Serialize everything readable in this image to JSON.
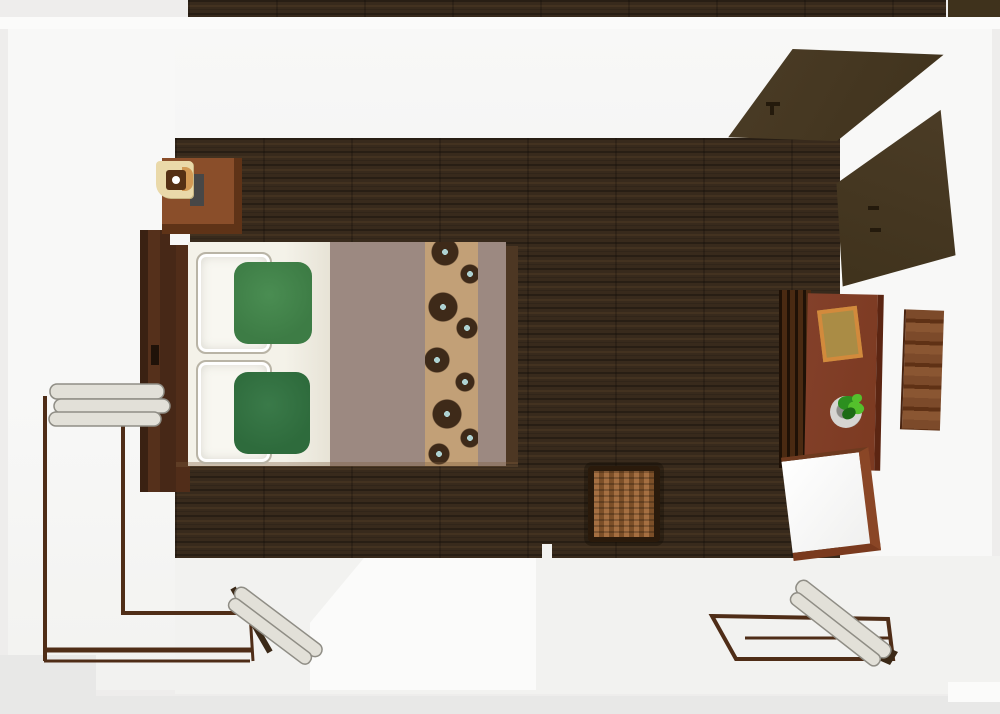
{
  "scene": {
    "title": "3D top-down render of a bedroom floor plan",
    "objects": [
      {
        "id": "room-floor",
        "label": "Dark walnut plank floor"
      },
      {
        "id": "hallway-floor",
        "label": "Adjacent floor strip beyond top wall"
      },
      {
        "id": "bed",
        "label": "Double bed with white sheets, taupe blanket and floral runner"
      },
      {
        "id": "headboard",
        "label": "Dark wood headboard"
      },
      {
        "id": "pillow-white-1",
        "label": "White pillow (top)"
      },
      {
        "id": "pillow-white-2",
        "label": "White pillow (bottom)"
      },
      {
        "id": "pillow-green-1",
        "label": "Green accent pillow (top)"
      },
      {
        "id": "pillow-green-2",
        "label": "Dark green accent pillow (bottom)"
      },
      {
        "id": "blanket",
        "label": "Taupe blanket"
      },
      {
        "id": "bed-runner-floral",
        "label": "Tan runner with brown flower pattern"
      },
      {
        "id": "nightstand",
        "label": "Wood nightstand"
      },
      {
        "id": "table-lamp",
        "label": "Square table lamp with cream shade"
      },
      {
        "id": "storage-basket",
        "label": "Wicker storage basket"
      },
      {
        "id": "desk",
        "label": "Sienna wood desk with drawers"
      },
      {
        "id": "desk-paper",
        "label": "Orange-bordered paper on desk"
      },
      {
        "id": "desk-plant",
        "label": "Potted green plant on desk"
      },
      {
        "id": "desk-chair",
        "label": "White chair with wood frame"
      },
      {
        "id": "wall-art",
        "label": "Wood-tone wall art"
      },
      {
        "id": "closet-door-upper",
        "label": "Open dark closet door panel (upper)"
      },
      {
        "id": "closet-door-lower",
        "label": "Open dark closet door panel (lower)"
      },
      {
        "id": "door-left",
        "label": "Open double door with white leaves, bottom-left"
      },
      {
        "id": "door-right",
        "label": "Open door with white leaf, bottom-right"
      }
    ]
  },
  "palette": {
    "outer": "#eeedec",
    "outerDark": "#e8e8e7",
    "wallWhite": "#f8f8f7",
    "wallBright": "#fbfbfa",
    "wallShade": "#f2f2f0",
    "floorBase": "#382a1c",
    "headboard": "#472817",
    "headboardDark": "#3a2112",
    "nightstandTop": "#8a4e2a",
    "nightstandEdge": "#5f3317",
    "lampShade": "#ead9a9",
    "lampRing": "#553014",
    "lampBulb": "#ffffff",
    "lampAccent": "#d29a55",
    "lampShadow": "#474747",
    "sheet": "#f4f2e9",
    "sheetShade": "#e7e3d6",
    "pillowWhite": "#f8f7f1",
    "pillowStitch": "#b9b4a6",
    "pillowGreen1": "#3d7c45",
    "pillowGreen2": "#2e6b3c",
    "blanket": "#9c8981",
    "runnerBg": "#c2a077",
    "runnerFlower": "#3e2a19",
    "runnerCenter": "#aed2d2",
    "basketLight": "#a56f41",
    "basketDark": "#7c4f28",
    "basketBorder": "#2a1a0b",
    "deskTop": "#7c3a21",
    "deskEdge": "#5b2512",
    "drawerDark": "#1f1106",
    "drawerLight": "#4a2a12",
    "paperFill": "#aa8c45",
    "paperBorder": "#d28a3c",
    "potLight": "#d6d5d2",
    "potDark": "#8e8e8a",
    "leaf1": "#2c8f1f",
    "leaf2": "#54c02c",
    "leaf3": "#1d6b16",
    "art": "#7c4a2a",
    "artDark": "#5f3115",
    "artLight": "#8a5632",
    "closetA": "#4b3c26",
    "closetB": "#3f321c",
    "closetHandle": "#241a0c",
    "doorFrame": "#4f2d17",
    "leafFill": "#e2e0d8",
    "leafStroke": "#8f8d85",
    "leafDark": "#3b2917",
    "chairFrame": "#8a4626"
  }
}
